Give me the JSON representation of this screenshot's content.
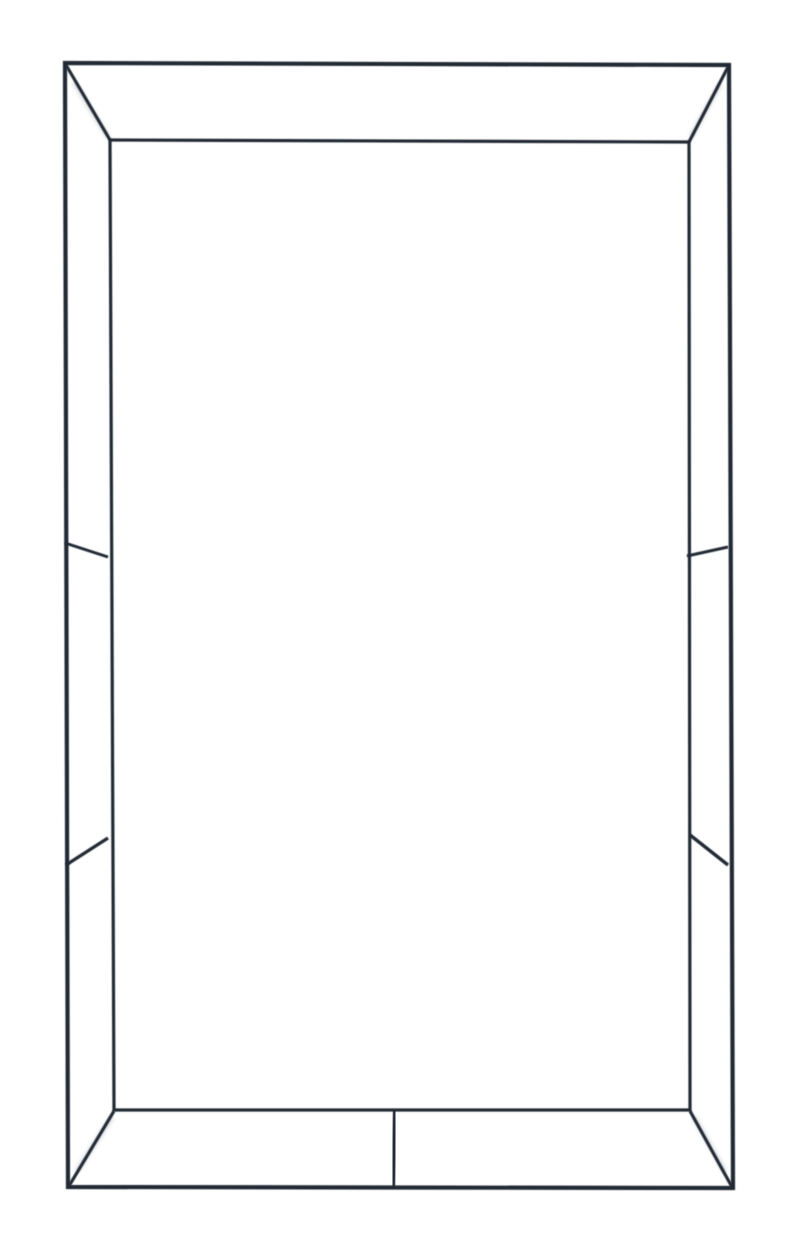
{
  "canvas": {
    "width": 800,
    "height": 1257,
    "background_color": "#ffffff"
  },
  "drawing": {
    "description": "Front view of a thin dark-metal rectangular frame with mitered corners; top and bottom bands split by one center divider, each side band split by two angled panel dividers; white background",
    "stroke_color": "#242b36",
    "shadow_color": "#8f97a3",
    "shadow_opacity": 0.32,
    "polygons": [
      {
        "name": "outer-frame-edge",
        "width": 4.2,
        "points": [
          [
            65,
            63
          ],
          [
            729,
            65
          ],
          [
            733,
            1188
          ],
          [
            68,
            1187
          ]
        ]
      },
      {
        "name": "inner-frame-edge",
        "width": 3.2,
        "points": [
          [
            110,
            140
          ],
          [
            689,
            142
          ],
          [
            690,
            1110
          ],
          [
            114,
            1110
          ]
        ]
      }
    ],
    "lines": [
      {
        "name": "miter-joint-top-left",
        "x1": 66,
        "y1": 65,
        "x2": 110,
        "y2": 140,
        "width": 3.2
      },
      {
        "name": "miter-joint-top-right",
        "x1": 728,
        "y1": 67,
        "x2": 689,
        "y2": 142,
        "width": 3.2
      },
      {
        "name": "miter-joint-bottom-right",
        "x1": 732,
        "y1": 1187,
        "x2": 690,
        "y2": 1111,
        "width": 3.2
      },
      {
        "name": "miter-joint-bottom-left",
        "x1": 69,
        "y1": 1186,
        "x2": 114,
        "y2": 1111,
        "width": 3.2
      },
      {
        "name": "divider-top-center",
        "x1": 399,
        "y1": 63,
        "x2": 399,
        "y2": 141,
        "width": 4.0
      },
      {
        "name": "divider-bottom-center",
        "x1": 395,
        "y1": 1110,
        "x2": 393,
        "y2": 1188,
        "width": 4.4
      },
      {
        "name": "divider-left-upper",
        "x1": 65,
        "y1": 543,
        "x2": 108,
        "y2": 557,
        "width": 3.0
      },
      {
        "name": "divider-left-lower",
        "x1": 66,
        "y1": 865,
        "x2": 108,
        "y2": 838,
        "width": 3.4
      },
      {
        "name": "divider-right-upper",
        "x1": 687,
        "y1": 556,
        "x2": 728,
        "y2": 547,
        "width": 3.0
      },
      {
        "name": "divider-right-lower",
        "x1": 690,
        "y1": 835,
        "x2": 728,
        "y2": 865,
        "width": 3.4
      }
    ],
    "shadows": [
      {
        "name": "shadow-miter-top-left",
        "x1": 74,
        "y1": 82,
        "x2": 108,
        "y2": 137,
        "width": 5
      },
      {
        "name": "shadow-miter-top-right",
        "x1": 720,
        "y1": 84,
        "x2": 691,
        "y2": 137,
        "width": 5
      },
      {
        "name": "shadow-miter-bottom-right",
        "x1": 725,
        "y1": 1172,
        "x2": 694,
        "y2": 1117,
        "width": 5
      },
      {
        "name": "shadow-miter-bottom-left",
        "x1": 77,
        "y1": 1171,
        "x2": 112,
        "y2": 1117,
        "width": 5
      }
    ]
  }
}
